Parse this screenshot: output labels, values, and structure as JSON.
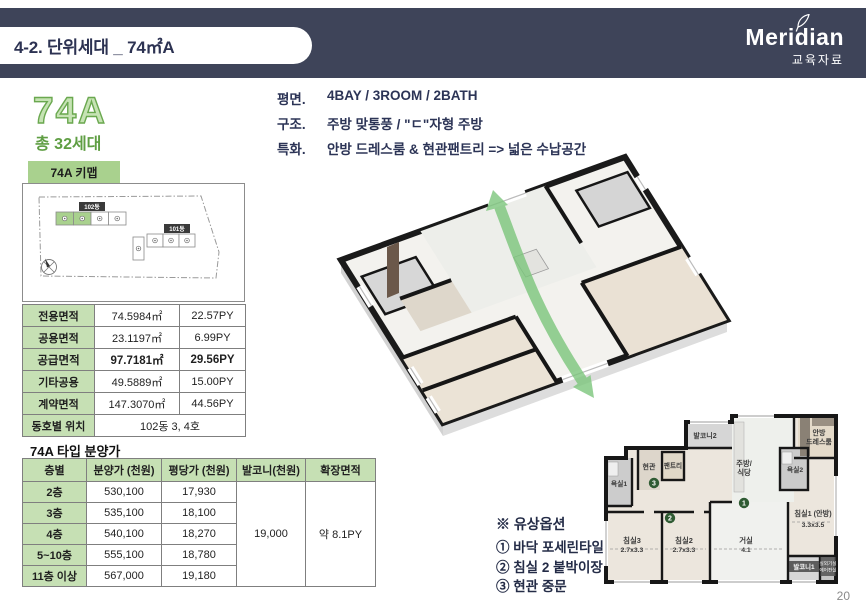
{
  "header": {
    "title": "4-2. 단위세대 _ 74㎡A",
    "brand": "Meridian",
    "brand_sub": "교육자료"
  },
  "unit": {
    "name": "74A",
    "households": "총 32세대"
  },
  "keymap": {
    "tab": "74A 키맵",
    "building_102": "102동",
    "building_101": "101동"
  },
  "specs": {
    "rows": [
      {
        "label": "평면.",
        "value": "4BAY / 3ROOM / 2BATH"
      },
      {
        "label": "구조.",
        "value": "주방 맞통풍 / \"ㄷ\"자형 주방"
      },
      {
        "label": "특화.",
        "value": "안방 드레스룸 & 현관팬트리 => 넓은 수납공간"
      }
    ]
  },
  "area_table": {
    "rows": [
      {
        "label": "전용면적",
        "sqm": "74.5984㎡",
        "py": "22.57PY"
      },
      {
        "label": "공용면적",
        "sqm": "23.1197㎡",
        "py": "6.99PY"
      },
      {
        "label": "공급면적",
        "sqm": "97.7181㎡",
        "py": "29.56PY"
      },
      {
        "label": "기타공용",
        "sqm": "49.5889㎡",
        "py": "15.00PY"
      },
      {
        "label": "계약면적",
        "sqm": "147.3070㎡",
        "py": "44.56PY"
      }
    ],
    "location_label": "동호별 위치",
    "location_value": "102동 3, 4호"
  },
  "price_table": {
    "title": "74A 타입 분양가",
    "headers": {
      "floor": "층별",
      "price": "분양가 (천원)",
      "per_py": "평당가 (천원)",
      "balcony": "발코니(천원)",
      "extension": "확장면적"
    },
    "rows": [
      {
        "floor": "2층",
        "price": "530,100",
        "per_py": "17,930"
      },
      {
        "floor": "3층",
        "price": "535,100",
        "per_py": "18,100"
      },
      {
        "floor": "4층",
        "price": "540,100",
        "per_py": "18,270"
      },
      {
        "floor": "5~10층",
        "price": "555,100",
        "per_py": "18,780"
      },
      {
        "floor": "11층 이상",
        "price": "567,000",
        "per_py": "19,180"
      }
    ],
    "balcony_value": "19,000",
    "extension_value": "약 8.1PY"
  },
  "options": {
    "title": "※ 유상옵션",
    "items": [
      "① 바닥 포세린타일",
      "② 침실 2 붙박이장",
      "③ 현관 중문"
    ]
  },
  "floorplan": {
    "balcony2": "발코니2",
    "entrance": "현관",
    "pantry": "팬트리",
    "bath1": "욕실1",
    "kitchen_line1": "주방/",
    "kitchen_line2": "식당",
    "dress_line1": "안방",
    "dress_line2": "드레스룸",
    "bath2": "욕실2",
    "bedroom3": "침실3",
    "bedroom3_dim": "2.7x3.3",
    "bedroom2": "침실2",
    "bedroom2_dim": "2.7x3.3",
    "living": "거실",
    "living_dim": "4.1",
    "bedroom1": "침실1 (안방)",
    "bedroom1_dim": "3.3x3.5",
    "balcony1": "발코니1",
    "ac_room_line1": "실외기실",
    "ac_room_line2": "에어컨실",
    "marker1": "1",
    "marker2": "2",
    "marker3": "3"
  },
  "page_number": "20",
  "colors": {
    "navy": "#3e4459",
    "accent_green": "#a9d18e",
    "table_header_green": "#c6e0b4",
    "dark_green_text": "#5f9e43",
    "marker_green": "#2f5b33",
    "arrow_green": "#7cc67c"
  }
}
